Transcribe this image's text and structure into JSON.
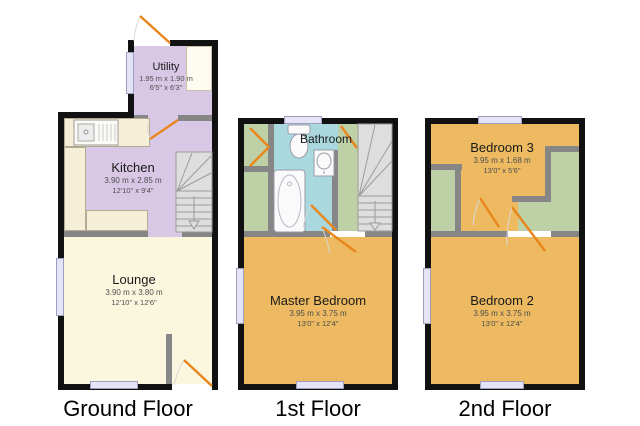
{
  "figure": {
    "type": "floorplan",
    "floor_count": 3
  },
  "floors": [
    {
      "label": "Ground Floor",
      "rooms": [
        {
          "name": "Utility",
          "dim_m": "1.95 m x 1.90 m",
          "dim_ft": "6'5\" x 6'3\""
        },
        {
          "name": "Kitchen",
          "dim_m": "3.90 m x 2.85 m",
          "dim_ft": "12'10\" x 9'4\""
        },
        {
          "name": "Lounge",
          "dim_m": "3.90 m x 3.80 m",
          "dim_ft": "12'10\" x 12'6\""
        }
      ]
    },
    {
      "label": "1st Floor",
      "rooms": [
        {
          "name": "Bathroom"
        },
        {
          "name": "Master Bedroom",
          "dim_m": "3.95 m x 3.75 m",
          "dim_ft": "13'0\" x 12'4\""
        }
      ]
    },
    {
      "label": "2nd Floor",
      "rooms": [
        {
          "name": "Bedroom 3",
          "dim_m": "3.95 m x 1.68 m",
          "dim_ft": "13'0\" x 5'6\""
        },
        {
          "name": "Bedroom 2",
          "dim_m": "3.95 m x 3.75 m",
          "dim_ft": "13'0\" x 12'4\""
        }
      ]
    }
  ],
  "colors": {
    "wall_exterior": "#111111",
    "wall_interior": "#868686",
    "room_lavender": "#d8c8e6",
    "room_cream": "#fbf7de",
    "room_orange": "#edb961",
    "room_blue": "#a9d9de",
    "room_green": "#bed0a6",
    "door_swing": "#e8861c",
    "window_fill": "#e4e4f6",
    "stairs_fill": "#dedede"
  }
}
